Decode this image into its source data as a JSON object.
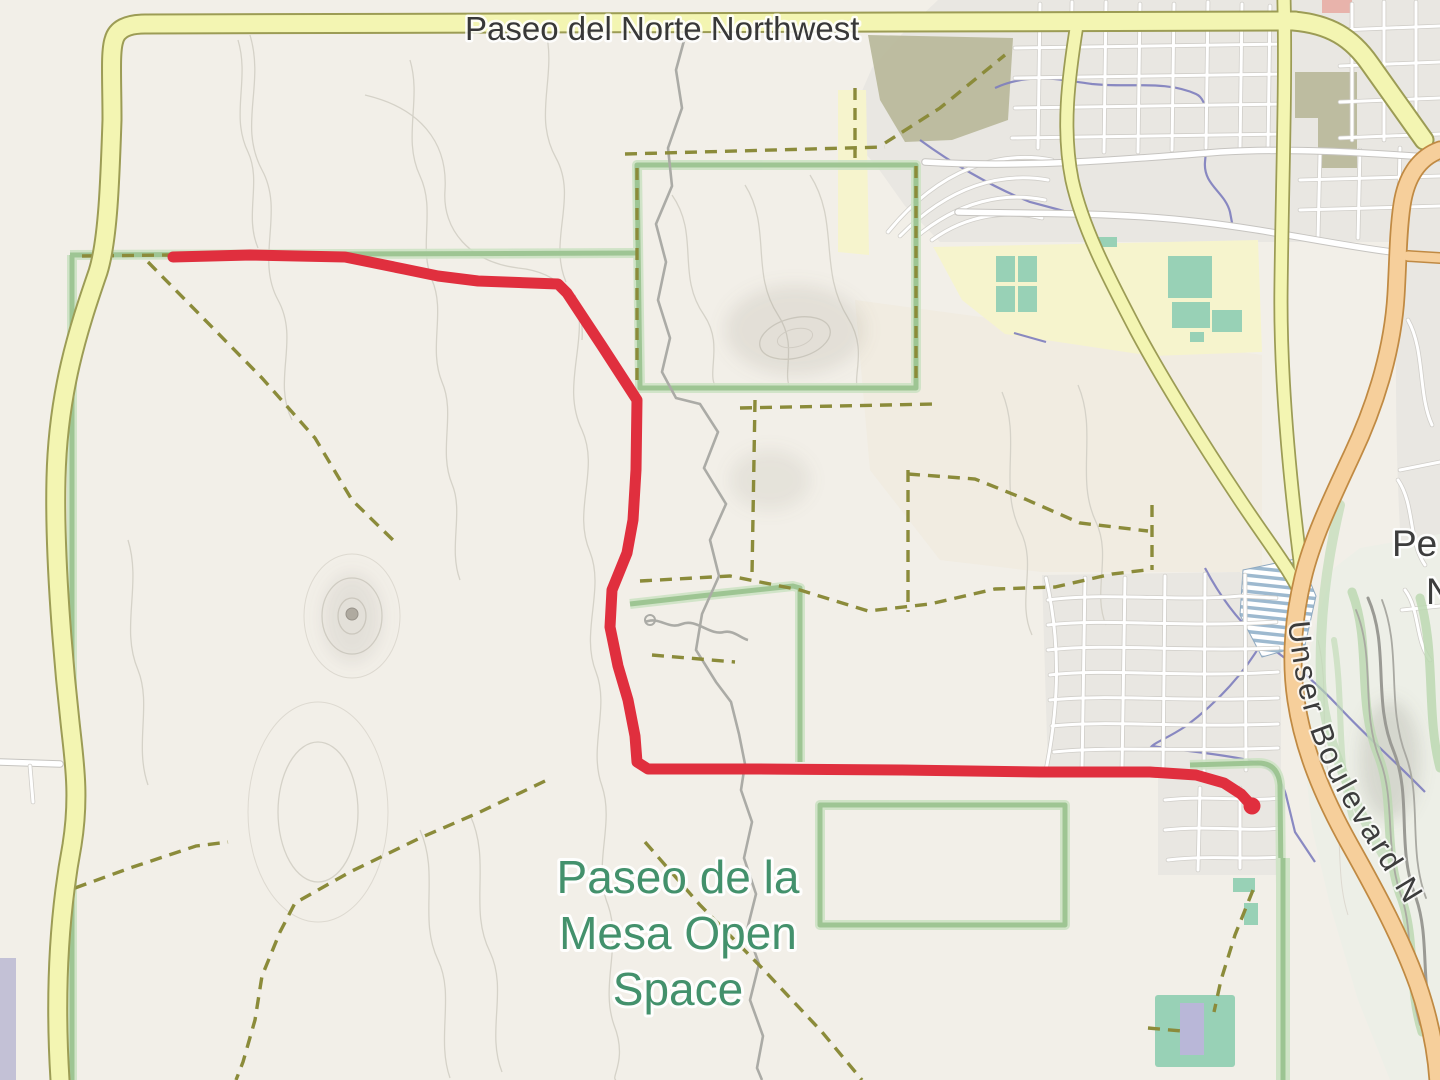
{
  "labels": {
    "top_road": "Paseo del Norte Northwest",
    "curved_road": "Unser Boulevard N",
    "open_space": {
      "line1": "Paseo de la",
      "line2": "Mesa Open",
      "line3": "Space"
    },
    "edge_partial": {
      "line1": "Pe",
      "line2": "N"
    }
  },
  "route": {
    "color": "#e02f3e",
    "polyline": "173,257 250,255 345,257 404,269 438,276 478,281 558,284 567,293 602,346 626,383 637,400 636,470 633,520 627,553 612,590 610,627 618,666 628,700 635,736 637,762 648,769 760,769 900,770 1040,772 1150,772 1196,775 1224,783 1241,794 1252,806",
    "end_transform": "translate(1252,806)",
    "start_x": "173",
    "start_y": "257",
    "end_x": "1252",
    "end_y": "806"
  },
  "colors": {
    "background": "#f2efe8",
    "urban": "#e9e7e2",
    "road_primary_fill": "#f3f5b2",
    "road_primary_casing": "#9c9c55",
    "road_secondary_fill": "#f6cf9b",
    "road_secondary_casing": "#c08a43",
    "boundary_green": "#95c08b",
    "trail_dashed": "#8b8b3a",
    "contour": "#d5d2c8",
    "water": "#7d7dbe",
    "open_space_label": "#43916c",
    "school_area": "#f6f4cd",
    "sports_pitch": "#98d1b6",
    "khaki_area": "#b8b89a",
    "route_red": "#e02f3e"
  }
}
